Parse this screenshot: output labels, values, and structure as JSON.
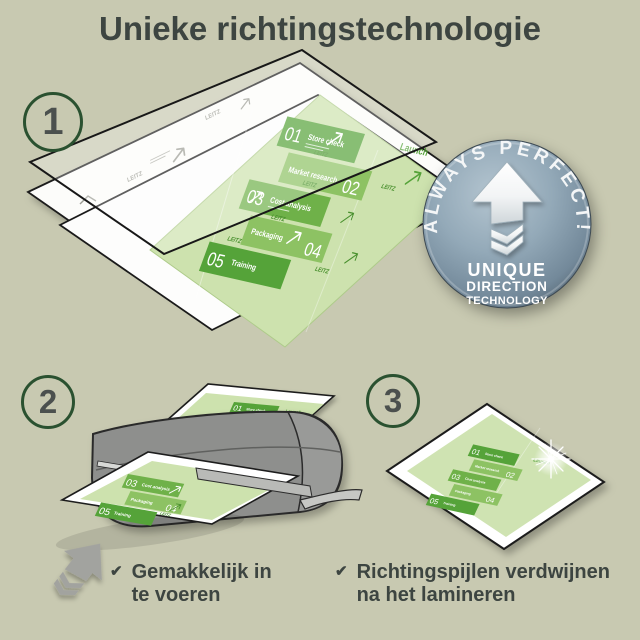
{
  "title": "Unieke richtingstechnologie",
  "steps": {
    "one": "1",
    "two": "2",
    "three": "3"
  },
  "badge": {
    "arc_text": "ALWAYS PERFECT!",
    "line1": "UNIQUE",
    "line2": "DIRECTION",
    "line3": "TECHNOLOGY"
  },
  "doc": {
    "items": [
      {
        "num": "01",
        "label": "Store check"
      },
      {
        "num": "02",
        "label": "Market research"
      },
      {
        "num": "03",
        "label": "Cost analysis"
      },
      {
        "num": "04",
        "label": "Packaging"
      },
      {
        "num": "05",
        "label": "Training"
      }
    ],
    "launch": "Launch",
    "brand": "LEITZ"
  },
  "checklist": {
    "item1": {
      "check": "✔",
      "line1": "Gemakkelijk in",
      "line2": "te voeren"
    },
    "item2": {
      "check": "✔",
      "line1": "Richtingspijlen verdwijnen",
      "line2": "na het lamineren"
    }
  },
  "colors": {
    "background": "#c8c9b1",
    "heading": "#3d4541",
    "circle_ring_green": "#2a5130",
    "tile_dark_green": "#55a339",
    "tile_mid_green": "#6fb149",
    "tile_light_green": "#8dc263",
    "doc_base_green": "#cde2ae",
    "badge_steel_blue": "#8099aa",
    "laminator_gray": "#8e8f8d"
  }
}
